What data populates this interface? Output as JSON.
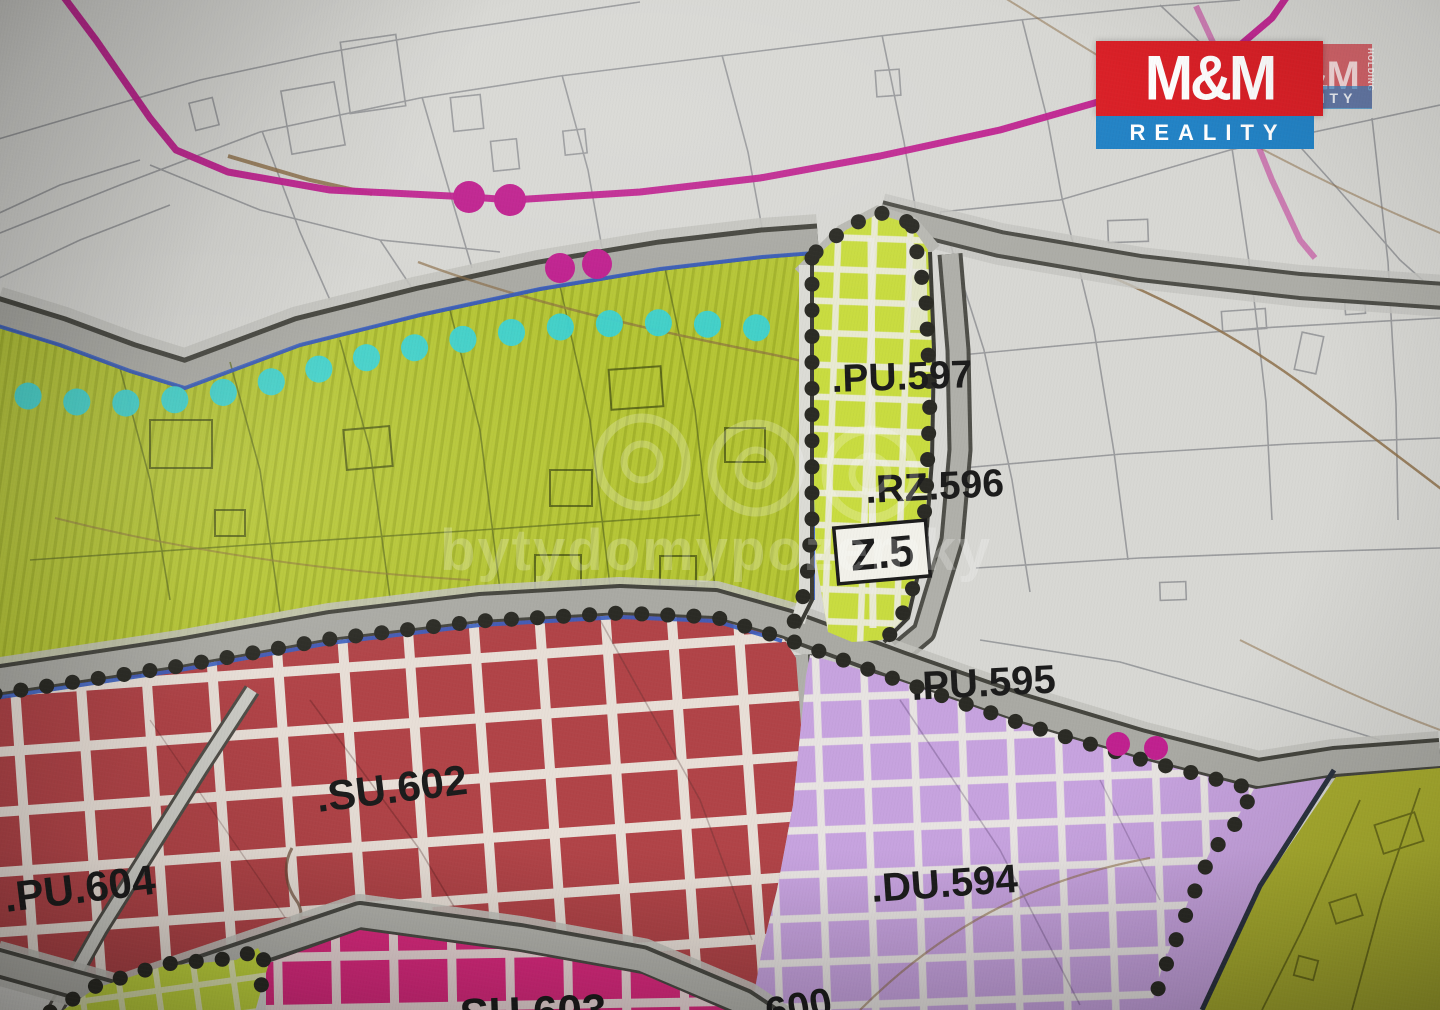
{
  "map": {
    "type": "municipal-zoning-plan",
    "zone_labels": {
      "pu597": ".PU.597",
      "rz596": ".RZ.596",
      "z5": "Z.5",
      "pu595": ".PU.595",
      "su602": ".SU.602",
      "pu604": ".PU.604",
      "du594": ".DU.594",
      "su603_partial": ".SU.603",
      "code600_partial": "600"
    },
    "colors": {
      "background": "#d8d8d4",
      "green_belt": "#b6c636",
      "z5_strip": "#c9dc40",
      "red_zone": "#b14448",
      "pink_zone": "#de2a80",
      "purple_zone": "#c7a3df",
      "olive_zone": "#a9ad2f",
      "lime_corner": "#c4d83e",
      "road_gray": "#aaaaa4",
      "boundary_dots": "#2b2b25",
      "cyan_dots": "#3ed2d2",
      "magenta_accent": "#c0218f",
      "blue_line": "#3a5fc0",
      "grid_white": "#ecebe2"
    }
  },
  "watermark": {
    "text": "bytydomypozemky"
  },
  "logo": {
    "mm": "M&M",
    "reality": "REALITY",
    "holding": "HOLDING"
  }
}
